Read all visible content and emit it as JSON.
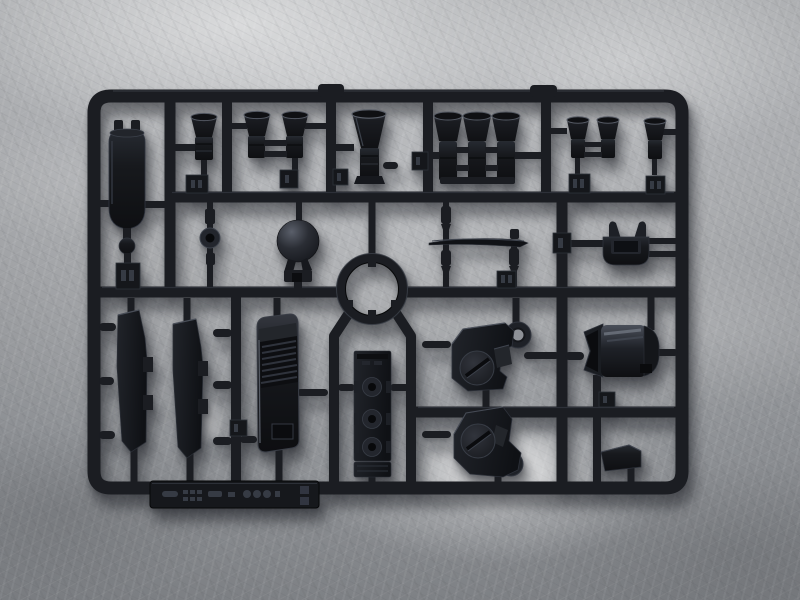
{
  "scene": {
    "type": "photograph",
    "subject": "Black plastic model-kit parts sprue (injection-molded runner) lying on a gray crumpled-texture surface",
    "lighting": "soft top light with glare patch near bottom center, soft shadow cast below the runner"
  },
  "colors": {
    "background_light": "#c9cbcd",
    "background_mid": "#aaacaf",
    "background_dark": "#8d9094",
    "plastic_base": "#1b1d22",
    "plastic_dark": "#0b0c0f",
    "plastic_highlight": "#4a4f59",
    "glare": "#ffffff"
  },
  "sprue": {
    "frame": "rounded rectangular outer runner with internal horizontal and vertical rails; circular runner opening holding a ring part at center",
    "markings": {
      "nameplate": "embossed molded maker text and digits on bottom bar (illegible in photo)",
      "part_number_tags": "small embossed part-number plates attached to runners (digits illegible in photo)"
    },
    "parts": [
      {
        "name": "fuel-tank-cylinder",
        "desc": "tall round tank with two top nubs and ball joint below",
        "area": "top-left"
      },
      {
        "name": "small-thruster-bell",
        "desc": "single flared thruster bell with ribbed base",
        "area": "top row"
      },
      {
        "name": "paired-thruster-bells",
        "desc": "two thruster bells joined by crossbars",
        "area": "top row"
      },
      {
        "name": "large-thruster-bell",
        "desc": "large flared thruster bell",
        "area": "top row center"
      },
      {
        "name": "triple-thruster-bank",
        "desc": "three thruster bells joined at base",
        "area": "top row right-center"
      },
      {
        "name": "small-paired-thrusters",
        "desc": "two small bells with crossbars",
        "area": "top-right"
      },
      {
        "name": "single-small-thruster",
        "desc": "one small bell",
        "area": "top-right corner"
      },
      {
        "name": "ball-joint-washer",
        "desc": "rod with washer disc and hole",
        "area": "second row left"
      },
      {
        "name": "dome-sphere",
        "desc": "glossy hemispherical dome on bracket",
        "area": "second row"
      },
      {
        "name": "collar-ring",
        "desc": "circular ring part inside circular runner opening",
        "area": "center"
      },
      {
        "name": "thin-horizontal-blade",
        "desc": "long thin blade held by two tapered rods",
        "area": "second row right-center"
      },
      {
        "name": "two-prong-clamp",
        "desc": "U-cup with two upward prongs",
        "area": "second row right"
      },
      {
        "name": "skirt-armor-panel-left",
        "desc": "tall angled armor panel with side tabs",
        "area": "lower-left"
      },
      {
        "name": "skirt-armor-panel-right",
        "desc": "tall angled armor panel with side tabs",
        "area": "lower-left"
      },
      {
        "name": "louvered-vent-grille",
        "desc": "glossy plate with louver slats and recessed notch",
        "area": "lower-left center"
      },
      {
        "name": "hinge-strip-with-discs",
        "desc": "flat strip with three round bosses with holes, plus end plate",
        "area": "lower center"
      },
      {
        "name": "disc-bracket-upper",
        "desc": "angular bracket with round disc, slot and eyelet lug",
        "area": "lower right-center"
      },
      {
        "name": "disc-bracket-lower",
        "desc": "mirrored angular bracket with disc and eyelet lug",
        "area": "lower right-center"
      },
      {
        "name": "cylindrical-housing",
        "desc": "horizontal cylinder with notched flared end",
        "area": "right column"
      },
      {
        "name": "wedge-foot",
        "desc": "small angled wedge block",
        "area": "bottom right"
      },
      {
        "name": "nameplate-bar",
        "desc": "flat bar with embossed illegible lettering",
        "area": "bottom edge"
      }
    ]
  }
}
